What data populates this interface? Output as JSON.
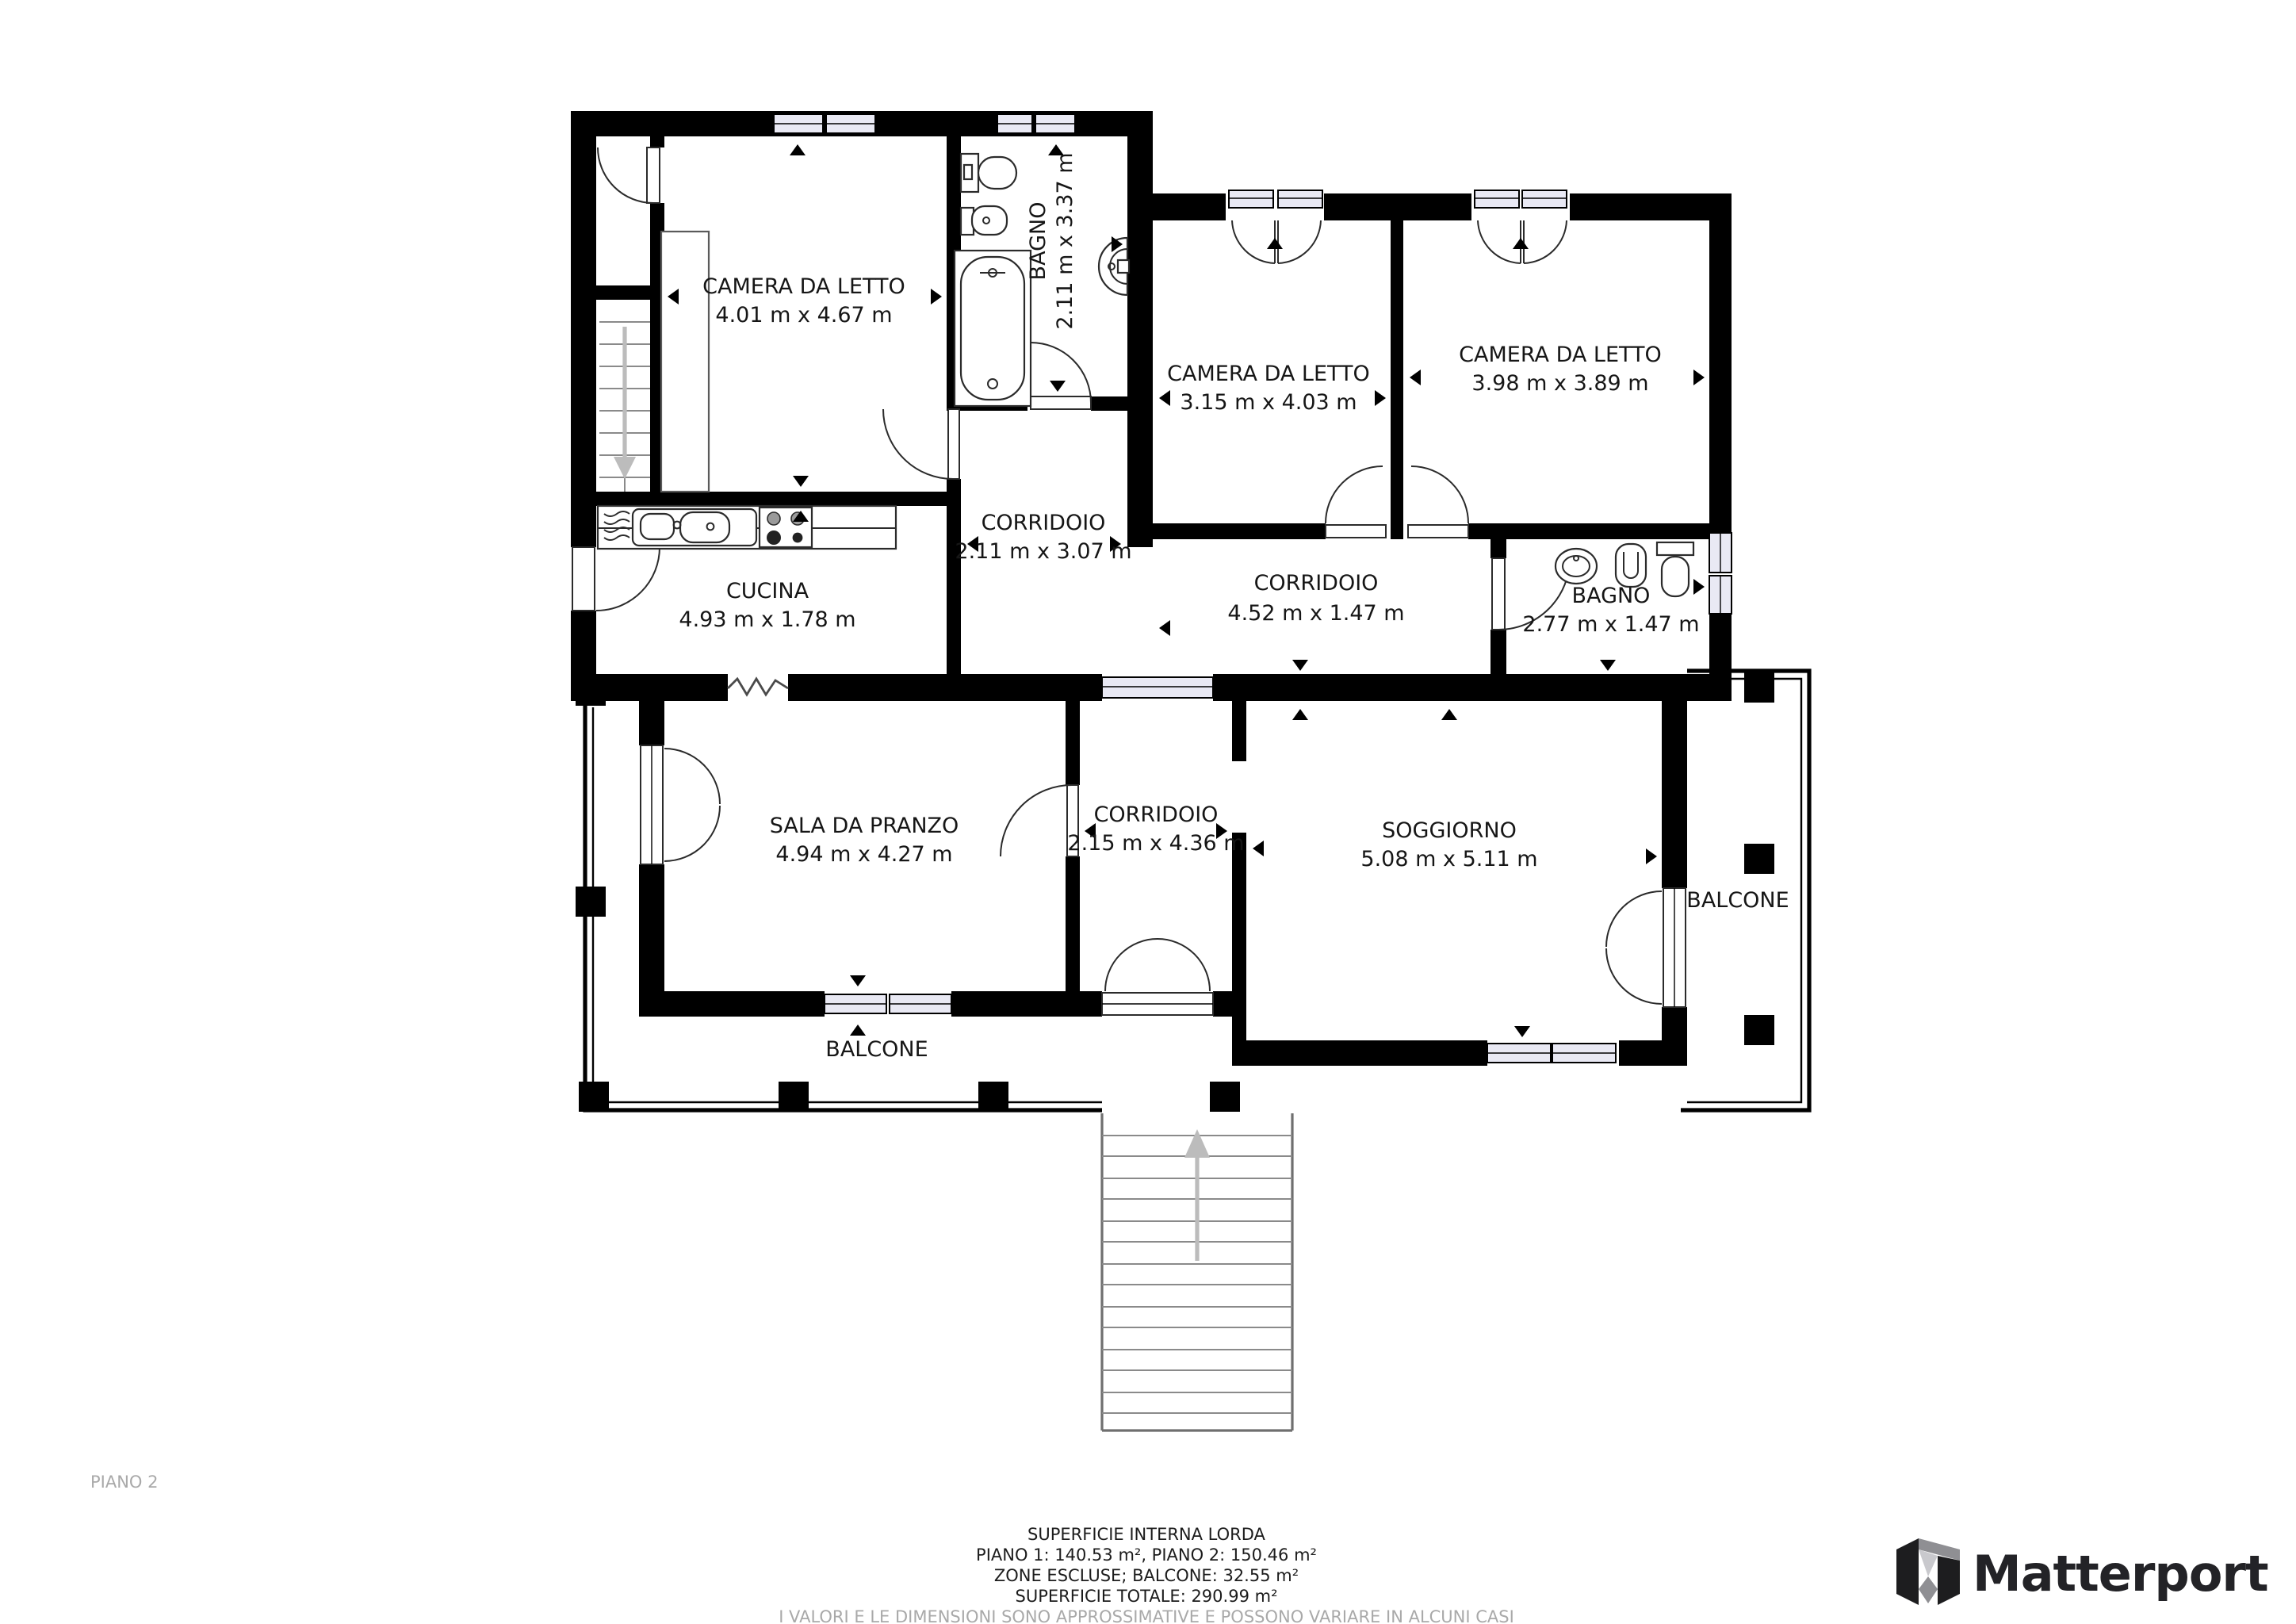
{
  "floor_label": "PIANO 2",
  "rooms": [
    {
      "id": "camera-da-letto-1",
      "name": "CAMERA DA LETTO",
      "dims": "4.01 m x 4.67 m"
    },
    {
      "id": "bagno-1",
      "name": "BAGNO",
      "dims": "2.11 m x 3.37 m"
    },
    {
      "id": "camera-da-letto-2",
      "name": "CAMERA DA LETTO",
      "dims": "3.15 m x 4.03 m"
    },
    {
      "id": "camera-da-letto-3",
      "name": "CAMERA DA LETTO",
      "dims": "3.98 m x 3.89 m"
    },
    {
      "id": "corridoio-1",
      "name": "CORRIDOIO",
      "dims": "2.11 m x 3.07 m"
    },
    {
      "id": "cucina",
      "name": "CUCINA",
      "dims": "4.93 m x 1.78 m"
    },
    {
      "id": "corridoio-2",
      "name": "CORRIDOIO",
      "dims": "4.52 m x 1.47 m"
    },
    {
      "id": "bagno-2",
      "name": "BAGNO",
      "dims": "2.77 m x 1.47 m"
    },
    {
      "id": "sala-da-pranzo",
      "name": "SALA DA PRANZO",
      "dims": "4.94 m x 4.27 m"
    },
    {
      "id": "corridoio-3",
      "name": "CORRIDOIO",
      "dims": "2.15 m x 4.36 m"
    },
    {
      "id": "soggiorno",
      "name": "SOGGIORNO",
      "dims": "5.08 m x 5.11 m"
    },
    {
      "id": "balcone-destro",
      "name": "BALCONE"
    },
    {
      "id": "balcone-inferiore",
      "name": "BALCONE"
    }
  ],
  "footer": {
    "superficie_title": "SUPERFICIE INTERNA LORDA",
    "piani": "PIANO 1: 140.53 m², PIANO 2: 150.46 m²",
    "zone_escluse": "ZONE ESCLUSE; BALCONE: 32.55 m²",
    "totale": "SUPERFICIE TOTALE: 290.99 m²",
    "disclaimer": "I VALORI E LE DIMENSIONI SONO APPROSSIMATIVE E POSSONO VARIARE IN ALCUNI CASI"
  },
  "brand": {
    "logo_text": "Matterport"
  },
  "colors": {
    "wall": "#000000",
    "window_glass": "#e9e9f4",
    "label": "#161616",
    "muted": "#a9a9a9",
    "logo": "#232327"
  }
}
